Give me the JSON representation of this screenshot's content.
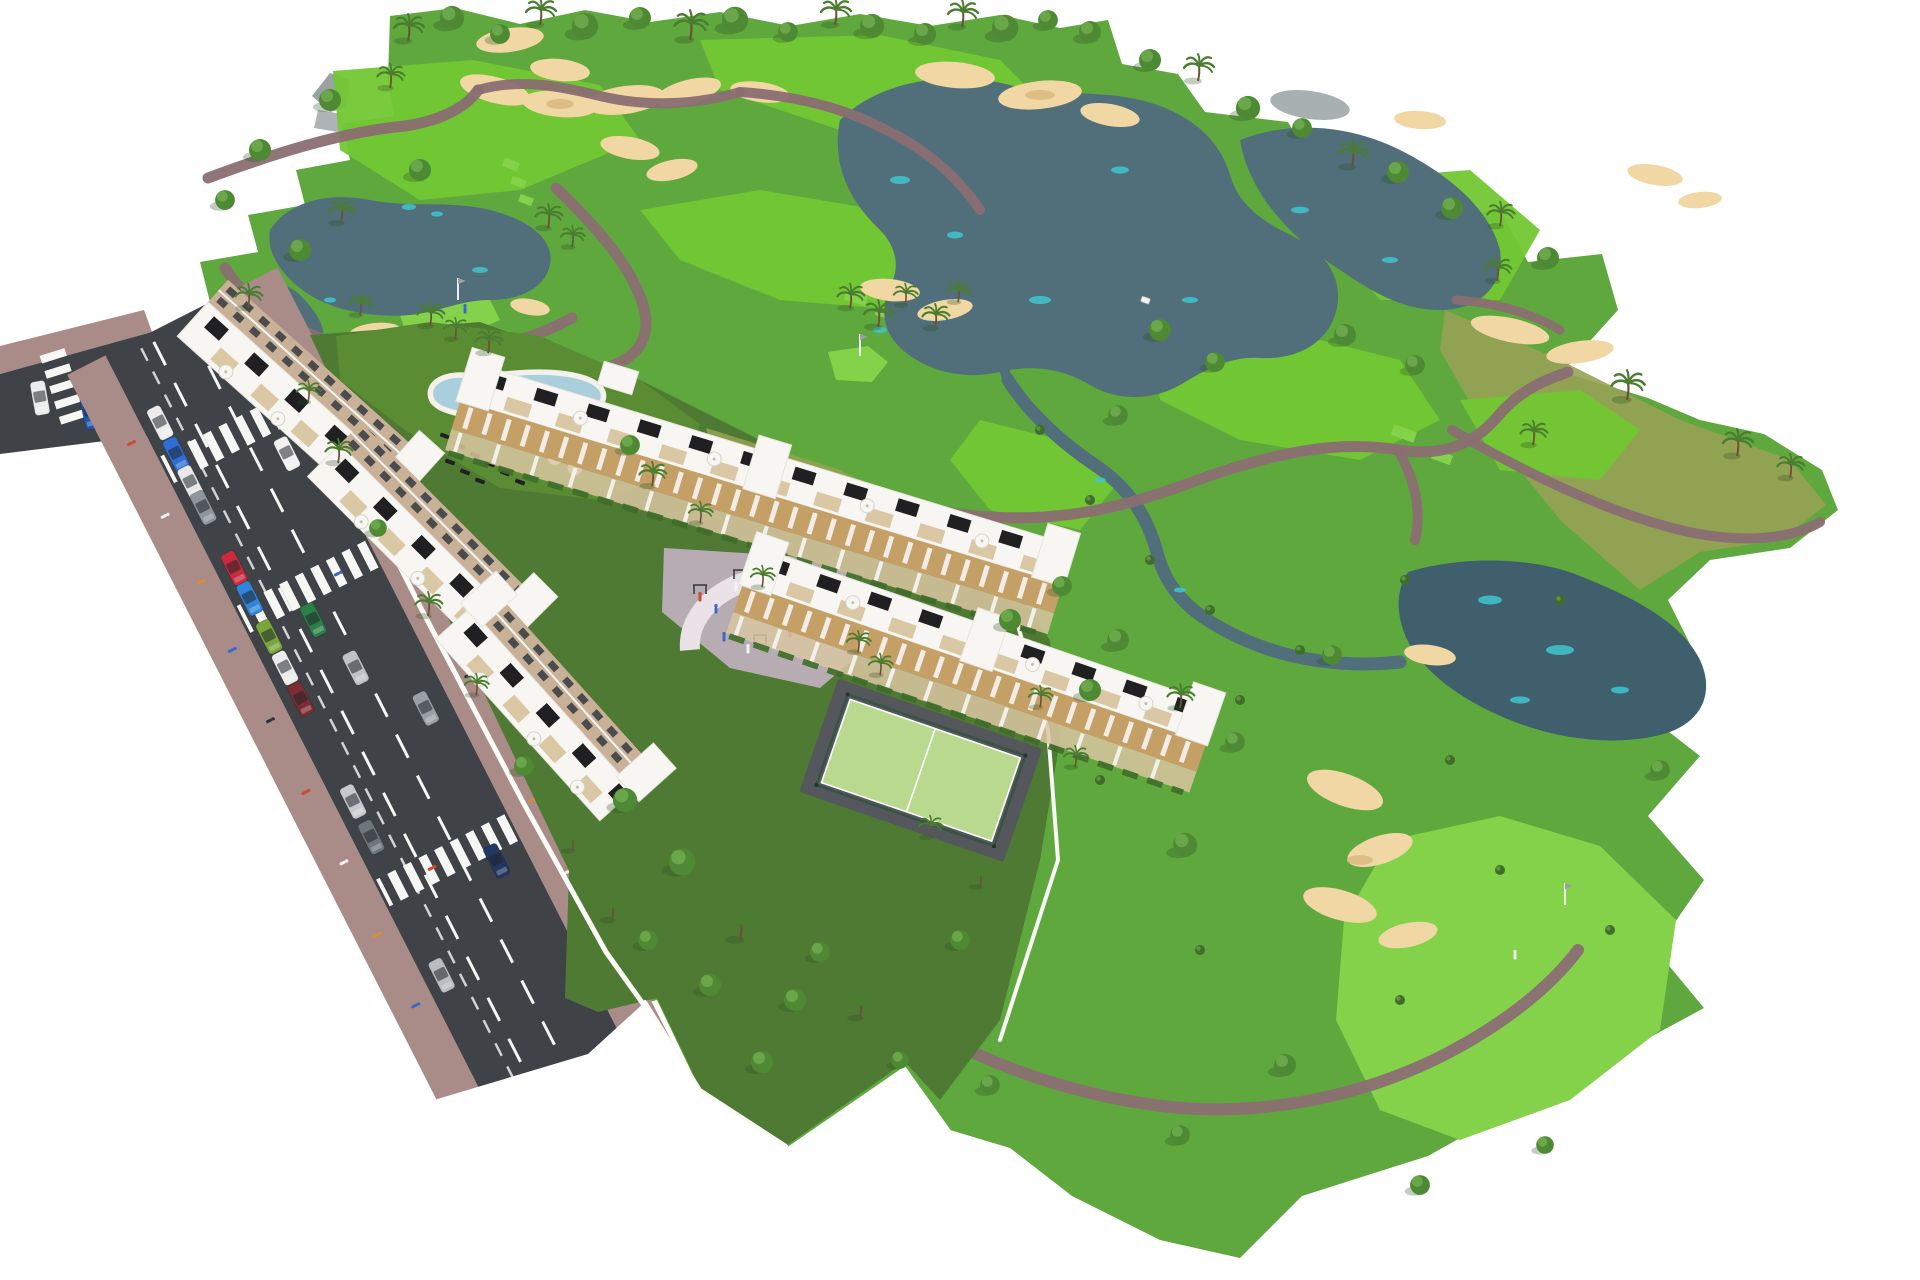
{
  "scene": {
    "alt": "Aerial 3D architectural rendering of a white low-rise apartment complex with rooftop terraces, communal pool, playground and padel court, beside an 18-hole style golf course with lakes, sand bunkers, winding cart paths, palm trees and a road with parked cars on the left"
  },
  "palette": {
    "grass_base": "#5fa83e",
    "garden_green": "#4f7a33",
    "lawn_olive": "#5a8c33",
    "dry_olive": "#97a254",
    "fairway": "#72c733",
    "green_bright": "#84d24a",
    "lake": "#506f7b",
    "lake_deep": "#3f5f6c",
    "lake_cyan": "#3fc6cf",
    "pond_gray": "#9fa9a8",
    "sand": "#f0d7a4",
    "sand_shadow": "#ddbd85",
    "path_mauve": "#8a6e72",
    "road_asphalt": "#3f4347",
    "marking_white": "#f6f6f4",
    "sidewalk_mauve": "#a98b88",
    "wall_white": "#fafaf7",
    "roof_white": "#f7f6f2",
    "roof_line": "#e6e3dc",
    "facade_beige": "#c9b197",
    "facade_wood": "#c49f66",
    "terrace_tan": "#d9c6a1",
    "pergola_dark": "#202022",
    "window_dark": "#3c4046",
    "pool_water": "#a9cfdc",
    "pool_water_light": "#c4e0e8",
    "deck_white": "#f3f1ea",
    "court_green": "#b9da8e",
    "court_dark": "#54585c",
    "fence_green": "#33523f",
    "plaza_pav": "#b7acb2",
    "plaza_band": "#e9e3e7",
    "tree_green": "#4e8a33",
    "tree_light": "#6aa64a",
    "palm_green": "#4a7d30",
    "trunk": "#6c5137",
    "shrub": "#3f6d2a",
    "ruin_gray": "#9aa1a4",
    "people_red": "#cf4a2e",
    "people_orange": "#e08a2e",
    "people_white": "#f2f2f2",
    "people_blue": "#3a67c9",
    "people_dark": "#2b3440"
  },
  "road": {
    "lane_count": 3,
    "crosswalk_count": 4,
    "parked_cars": [
      {
        "color": "#ececec"
      },
      {
        "color": "#2e6fd6"
      },
      {
        "color": "#e8e8e8"
      },
      {
        "color": "#8f969b"
      },
      {
        "color": "#c92b3d"
      },
      {
        "color": "#2f86d8"
      },
      {
        "color": "#79a63a"
      },
      {
        "color": "#ececec"
      },
      {
        "color": "#7c2d33"
      },
      {
        "color": "#c7cacd"
      },
      {
        "color": "#6e757b"
      },
      {
        "color": "#b9bdc1"
      }
    ],
    "moving_cars": [
      {
        "color": "#f1f1f1"
      },
      {
        "color": "#bfc3c7"
      },
      {
        "color": "#223761"
      },
      {
        "color": "#2d7f49"
      },
      {
        "color": "#9aa0a5"
      }
    ],
    "stub_cars": [
      {
        "color": "#ececec"
      },
      {
        "color": "#2456b0"
      }
    ]
  },
  "golf": {
    "flag_count": 3,
    "golfer_count": 2,
    "lake_count": 4,
    "bunker_cluster_count": 12
  },
  "amenities": [
    "swimming pool",
    "sun loungers",
    "parasols",
    "playground plaza",
    "outdoor gym",
    "padel court",
    "private gardens",
    "rooftop terraces"
  ],
  "buildings": {
    "left_block_slabs": 3,
    "right_rows": 2,
    "visible_floors": 4
  }
}
